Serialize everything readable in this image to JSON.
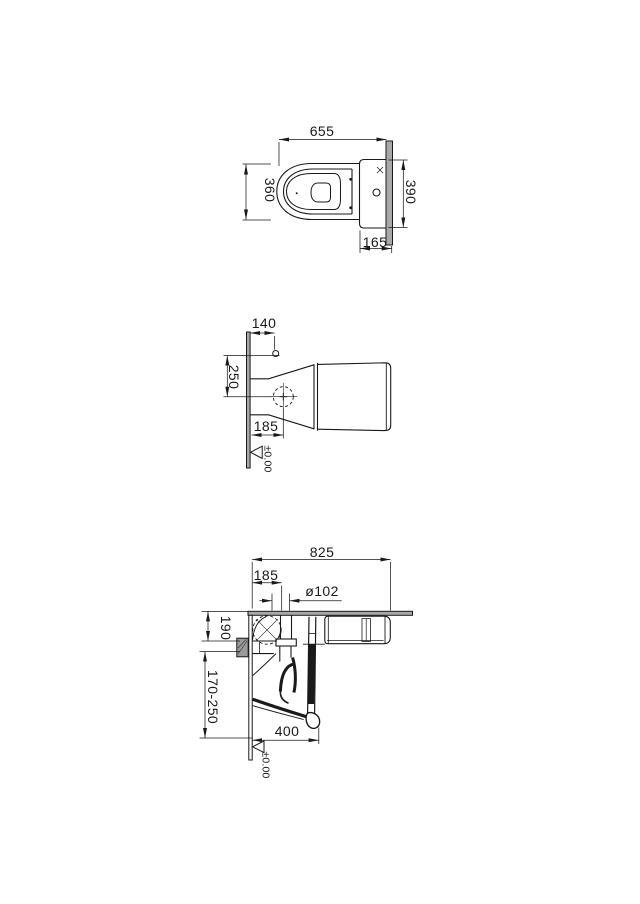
{
  "drawing": {
    "title": "WC technical dimension drawing",
    "background": "#ffffff",
    "line_color": "#1a1a1a",
    "wall_fill": "#a8a8a8",
    "top_view": {
      "length": "655",
      "width": "360",
      "cistern_width": "390",
      "cistern_depth": "165"
    },
    "underside_view": {
      "inlet_offset": "140",
      "bolt_spacing": "250",
      "outlet_offset": "185",
      "floor_datum": "±0.00"
    },
    "section_view": {
      "height": "825",
      "outlet_offset": "185",
      "outlet_diameter": "ø102",
      "outlet_to_wall": "190",
      "adjustable_range": "170-250",
      "bowl_depth": "400",
      "floor_datum": "±0.00"
    }
  }
}
